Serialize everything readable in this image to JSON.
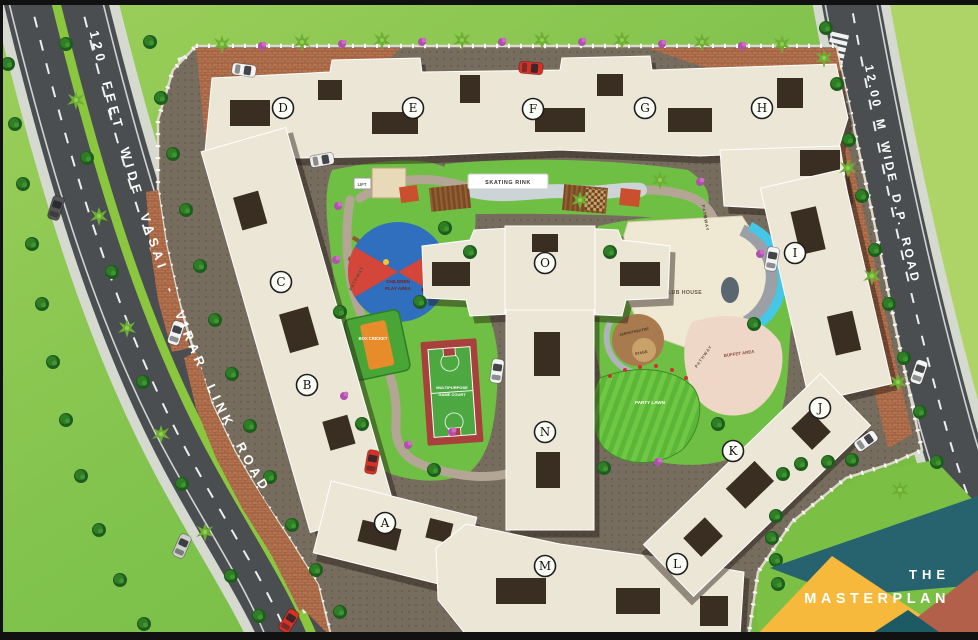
{
  "scene": {
    "name": "residential masterplan site map",
    "width": 978,
    "height": 640
  },
  "roads": {
    "left_label": "120 FEET WIDE  VASAI - VIRAR LINK ROAD",
    "right_label": "12.00 M WIDE D.P. ROAD"
  },
  "buildings": {
    "a": "A",
    "b": "B",
    "c": "C",
    "d": "D",
    "e": "E",
    "f": "F",
    "g": "G",
    "h": "H",
    "i": "I",
    "j": "J",
    "k": "K",
    "l": "L",
    "m": "M",
    "n": "N",
    "o": "O"
  },
  "amenities": {
    "skating_rink": "SKATING RINK",
    "children_play_line1": "CHILDREN",
    "children_play_line2": "PLAY AREA",
    "box_cricket": "BOX CRICKET",
    "game_court_line1": "MULTIPURPOSE",
    "game_court_line2": "GAME COURT",
    "club_house": "CLUB HOUSE",
    "amphitheatre": "AMPHITHEATRE",
    "stage": "STAGE",
    "buffet_area": "BUFFET AREA",
    "party_lawn": "PARTY LAWN",
    "pathway": "PATHWAY",
    "lift": "LIFT"
  },
  "badge": {
    "line1": "THE",
    "line2": "MASTERPLAN"
  },
  "colors": {
    "grass": "#7fc24c",
    "grass_light": "#aed468",
    "road": "#4a4e50",
    "median_green": "#8bc63f",
    "podium": "#776d5f",
    "paver": "#b57350",
    "building": "#ece6d6",
    "roof_core": "#3a2d22",
    "court_red": "#a8403c",
    "court_green": "#4ea842",
    "play_blue": "#2f6fbd",
    "play_red": "#d4453a",
    "pool_blue": "#45c8e8",
    "lawn_green": "#5cb637",
    "badge_teal": "#27626f",
    "badge_yellow": "#f6b93b",
    "badge_terracotta": "#b2604a",
    "badge_dark_teal": "#1c5a64"
  }
}
